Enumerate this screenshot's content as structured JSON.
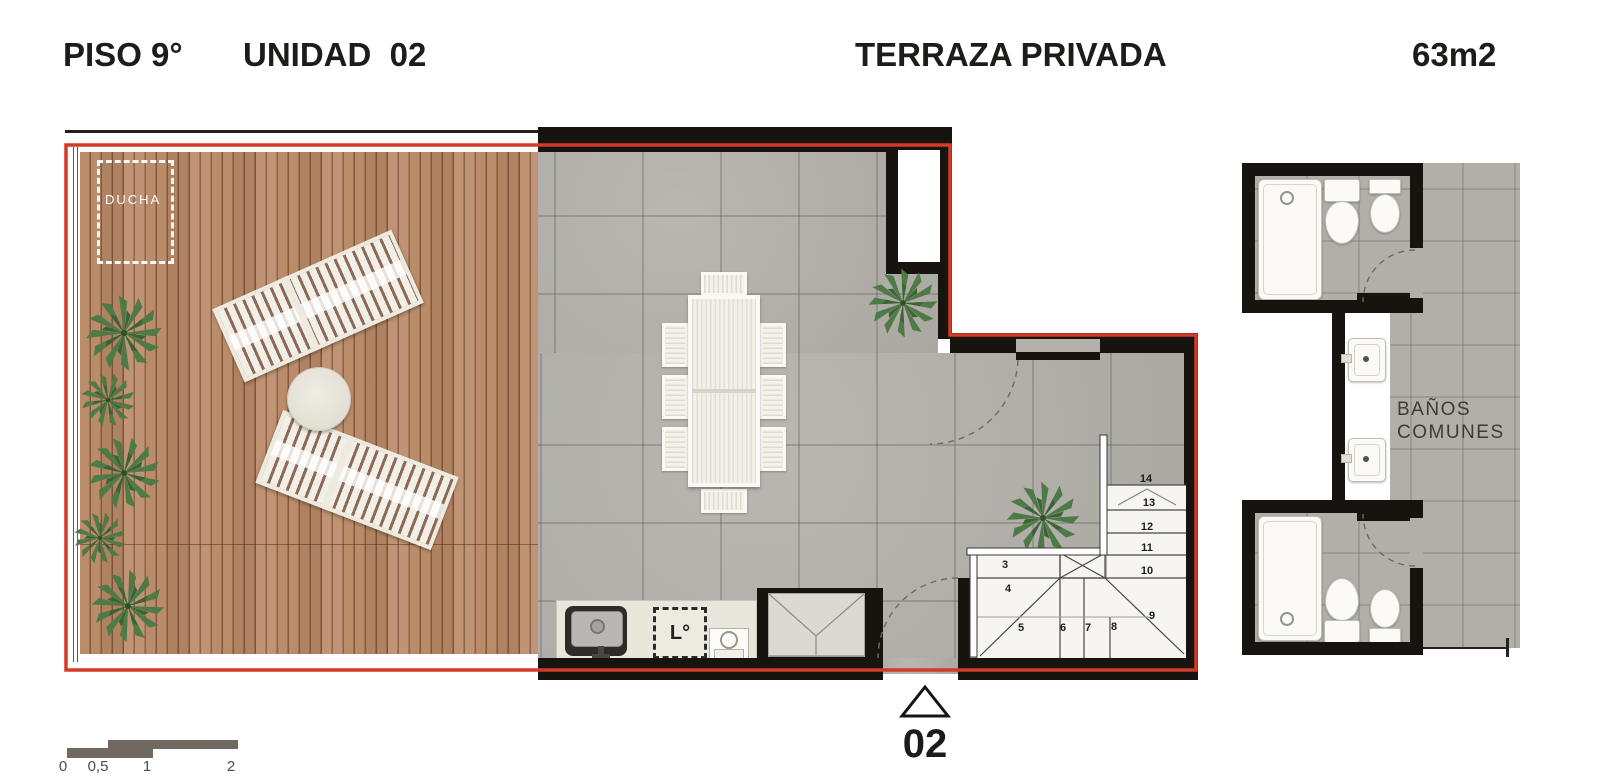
{
  "header": {
    "floor_label": "PISO 9°",
    "unit_label": "UNIDAD  02",
    "plan_type_label": "TERRAZA PRIVADA",
    "area_label": "63m2"
  },
  "terrace": {
    "shower_zone_label": "DUCHA"
  },
  "kitchen": {
    "laundry_label": "L°"
  },
  "common_bathrooms": {
    "label_line1": "BAÑOS",
    "label_line2": "COMUNES"
  },
  "stairs": {
    "steps": [
      {
        "n": "3",
        "x": 1005,
        "y": 565
      },
      {
        "n": "4",
        "x": 1008,
        "y": 589
      },
      {
        "n": "5",
        "x": 1021,
        "y": 628
      },
      {
        "n": "6",
        "x": 1063,
        "y": 628
      },
      {
        "n": "7",
        "x": 1088,
        "y": 628
      },
      {
        "n": "8",
        "x": 1114,
        "y": 627
      },
      {
        "n": "9",
        "x": 1152,
        "y": 616
      },
      {
        "n": "10",
        "x": 1147,
        "y": 571
      },
      {
        "n": "11",
        "x": 1147,
        "y": 548
      },
      {
        "n": "12",
        "x": 1147,
        "y": 527
      },
      {
        "n": "13",
        "x": 1149,
        "y": 503
      },
      {
        "n": "14",
        "x": 1146,
        "y": 479
      }
    ]
  },
  "unit_marker": {
    "number": "02"
  },
  "scale_bar": {
    "labels": [
      {
        "t": "0",
        "x": 63
      },
      {
        "t": "0,5",
        "x": 98
      },
      {
        "t": "1",
        "x": 147
      },
      {
        "t": "2",
        "x": 231
      }
    ]
  },
  "colors": {
    "accent_red": "#d43a28",
    "wall_black": "#17130f",
    "deck_wood": "#b5886a",
    "floor_tile": "#b4b1ab",
    "plant_green": "#4e7a46"
  }
}
